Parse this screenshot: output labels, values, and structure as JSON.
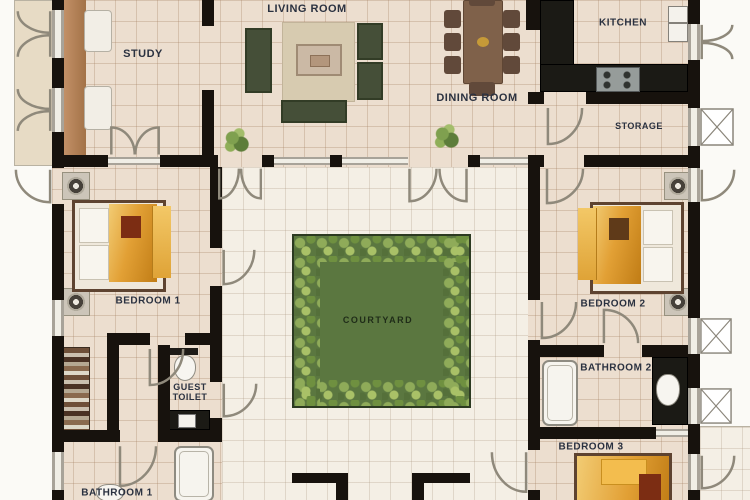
{
  "labels": {
    "living_room": "LIVING ROOM",
    "study": "STUDY",
    "kitchen": "KITCHEN",
    "dining_room": "DINING ROOM",
    "storage": "STORAGE",
    "bedroom1": "BEDROOM 1",
    "bedroom2": "BEDROOM 2",
    "bedroom3": "BEDROOM 3",
    "bathroom1": "BATHROOM 1",
    "bathroom2": "BATHROOM 2",
    "guest_toilet": "GUEST TOILET",
    "courtyard": "COURTYARD"
  },
  "palette": {
    "floor_tile": "#ecdecf",
    "hall_floor": "#f4efe5",
    "wall_black": "#17120d",
    "courtyard_green": "#5b7740",
    "leaf_light": "#a9c167",
    "duvet_orange": "#e2a035",
    "sofa_olive": "#454f38",
    "wood_brown": "#7f614a",
    "accent_red": "#7c2d13"
  }
}
